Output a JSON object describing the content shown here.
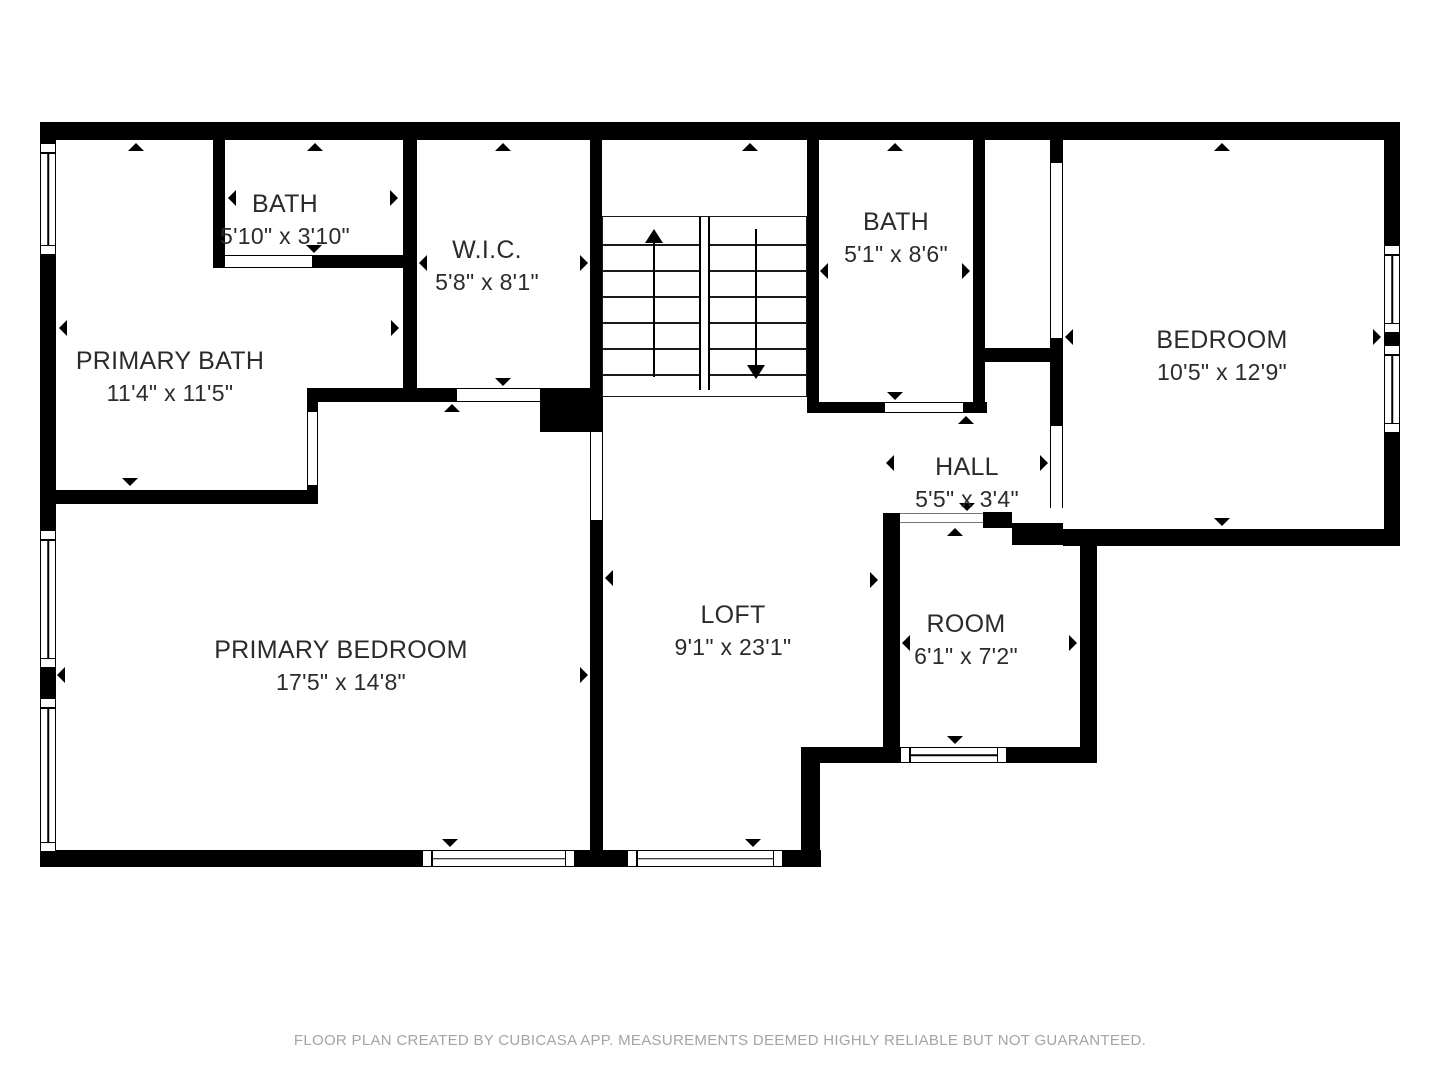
{
  "plan": {
    "rooms": [
      {
        "name": "PRIMARY BATH",
        "dims": "11'4\" x 11'5\""
      },
      {
        "name": "BATH",
        "dims": "5'10\" x 3'10\""
      },
      {
        "name": "W.I.C.",
        "dims": "5'8\" x 8'1\""
      },
      {
        "name": "BATH",
        "dims": "5'1\" x 8'6\""
      },
      {
        "name": "BEDROOM",
        "dims": "10'5\" x 12'9\""
      },
      {
        "name": "HALL",
        "dims": "5'5\" x 3'4\""
      },
      {
        "name": "LOFT",
        "dims": "9'1\" x 23'1\""
      },
      {
        "name": "ROOM",
        "dims": "6'1\" x 7'2\""
      },
      {
        "name": "PRIMARY BEDROOM",
        "dims": "17'5\" x 14'8\""
      }
    ],
    "footer": "FLOOR PLAN CREATED BY CUBICASA APP. MEASUREMENTS DEEMED HIGHLY RELIABLE BUT NOT GUARANTEED.",
    "colors": {
      "wall": "#000000",
      "text": "#2b2b2b",
      "footer": "#a4a4a4",
      "background": "#ffffff"
    }
  }
}
